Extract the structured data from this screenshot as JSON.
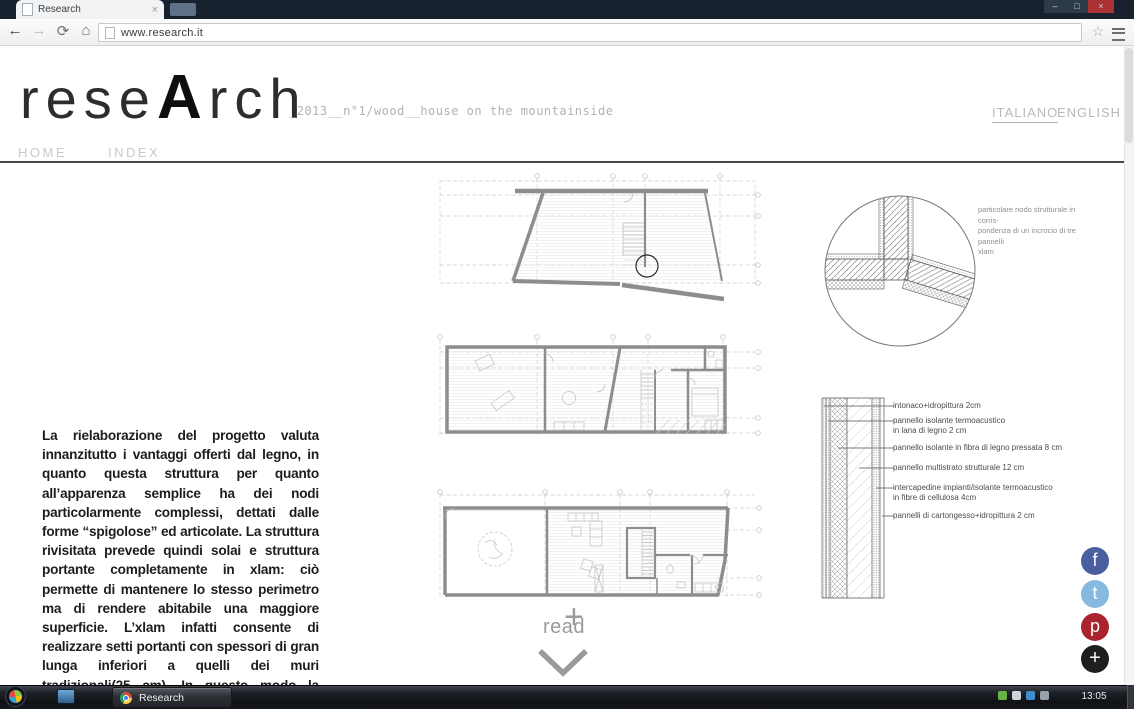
{
  "browser": {
    "tab_title": "Research",
    "tab_close": "×",
    "url": "www.research.it",
    "window_controls": {
      "minimize": "–",
      "maximize": "□",
      "close": "×"
    },
    "toolbar_icons": {
      "back": "←",
      "forward": "→",
      "refresh": "⟳",
      "home": "⌂",
      "bookmark": "☆"
    }
  },
  "site": {
    "logo": {
      "part1": "rese",
      "accent": "A",
      "part2": "rch"
    },
    "issue_subtitle": "_2013__n°1/wood__house on the mountainside",
    "nav": [
      {
        "label": "HOME"
      },
      {
        "label": "INDEX"
      }
    ],
    "languages": [
      {
        "label": "ITALIANO"
      },
      {
        "label": "ENGLISH"
      }
    ]
  },
  "article": {
    "body": "La rielaborazione del progetto valuta innanzitutto i vantaggi offerti dal legno, in quanto questa struttura per quanto all’apparenza semplice ha dei nodi particolarmente complessi, dettati dalle forme “spigolose” ed articolate. La struttura rivisitata prevede quindi solai e struttura portante completamente in xlam:  ciò permette di mantenere lo stesso perimetro ma di rendere abitabile una maggiore superficie. L’xlam infatti consente di realizzare setti portanti con spessori di gran lunga inferiori a quelli dei muri tradizionali(25 cm). In questo modo la struttura risulta più facilmente componibile e con un minore impatto sull’ambiente."
  },
  "detail_annotation": {
    "line1": "particolare nodo strutturale in corris-",
    "line2": "pondenza di un incrocio di tre pannelli",
    "line3": "xlam"
  },
  "wall_section_labels": [
    {
      "line1": "intonaco+idropittura 2cm",
      "line2": ""
    },
    {
      "line1": "pannello isolante termoacustico",
      "line2": "in lana di legno 2 cm"
    },
    {
      "line1": "pannello isolante in fibra di legno pressata 8 cm",
      "line2": ""
    },
    {
      "line1": "pannello multistrato strutturale 12 cm",
      "line2": ""
    },
    {
      "line1": "intercapedine impianti/isolante termoacustico",
      "line2": "in fibre di cellulosa 4cm"
    },
    {
      "line1": "pannelli di cartongesso+idropittura 2 cm",
      "line2": ""
    }
  ],
  "read_more": {
    "label": "read",
    "plus": "+"
  },
  "social": [
    {
      "name": "facebook",
      "glyph": "f",
      "color": "#4a5fa0",
      "css": "background:#4a5fa0"
    },
    {
      "name": "twitter",
      "glyph": "t",
      "color": "#85bade",
      "css": "background:#85bade"
    },
    {
      "name": "pinterest",
      "glyph": "p",
      "color": "#aa2430",
      "css": "background:#aa2430"
    },
    {
      "name": "share-plus",
      "glyph": "+",
      "color": "#1f1f1f",
      "css": "background:#1f1f1f"
    }
  ],
  "taskbar": {
    "running_app": "Research",
    "clock": "13:05"
  }
}
